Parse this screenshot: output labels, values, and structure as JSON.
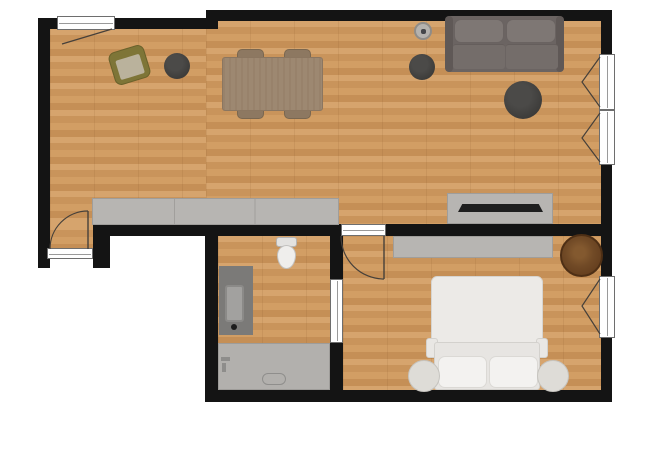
{
  "app": {
    "name": "floor-plan-view",
    "description": "Top-down 2D apartment floor plan with wood flooring, black walls, furnished rooms; no visible text labels"
  },
  "palette": {
    "wall": "#141414",
    "floor_wood_base": "#cf9c64",
    "floor_wood_dark": "#c58f56",
    "furniture_gray": "#b7b5b2",
    "sofa_gray": "#6b6462",
    "pouf_dark": "#3e3d3b",
    "dining_table_wood": "#9d8871",
    "round_table_wood": "#6b4523",
    "armchair_olive": "#7e7537",
    "bed_white": "#eceae7",
    "bathtub_gray": "#b2b0ad",
    "vanity_gray": "#7b7a78",
    "window_frame": "#ffffff",
    "background": "#ffffff"
  },
  "rooms": [
    {
      "name": "living-dining-room",
      "items": [
        "casement window (top wall)",
        "olive armchair",
        "round floor cushion x2",
        "large round floor cushion",
        "round planter",
        "dining table with 4 chairs",
        "two-seat sofa",
        "long sideboard counter",
        "TV sideboard with flat TV",
        "two casement windows (right wall)"
      ]
    },
    {
      "name": "entrance-nook",
      "items": [
        "entrance door with swing arc"
      ]
    },
    {
      "name": "bathroom",
      "items": [
        "toilet",
        "vanity with sink",
        "bathtub with headrest",
        "sliding door to bedroom"
      ]
    },
    {
      "name": "bedroom",
      "items": [
        "hinged door with swing arc",
        "wardrobe",
        "round wooden side table",
        "double bed with two pillows",
        "two round bedside stools",
        "casement window (right wall)"
      ]
    }
  ],
  "furniture": {
    "sofa": {
      "label": "Two-seat sofa"
    },
    "armchair": {
      "label": "Olive armchair"
    },
    "dining_table": {
      "label": "Dining table"
    },
    "dining_chair": {
      "label": "Dining chair"
    },
    "floor_cushion_small_1": {
      "label": "Round floor cushion"
    },
    "floor_cushion_small_2": {
      "label": "Round floor cushion"
    },
    "floor_cushion_large": {
      "label": "Large round floor cushion"
    },
    "planter": {
      "label": "Round planter"
    },
    "kitchen_sideboard": {
      "label": "Long sideboard counter"
    },
    "tv_sideboard": {
      "label": "TV sideboard"
    },
    "tv": {
      "label": "Flat-screen TV"
    },
    "wardrobe": {
      "label": "Wardrobe"
    },
    "round_side_table": {
      "label": "Round wooden side table"
    },
    "bed": {
      "label": "Double bed"
    },
    "pillow": {
      "label": "Pillow"
    },
    "bedside_stool": {
      "label": "Round bedside stool"
    },
    "toilet": {
      "label": "Toilet"
    },
    "vanity": {
      "label": "Vanity with sink"
    },
    "bathtub": {
      "label": "Bathtub"
    }
  },
  "openings": {
    "top_window": {
      "label": "Casement window"
    },
    "right_window_upper": {
      "label": "Casement window"
    },
    "right_window_lower": {
      "label": "Casement window"
    },
    "bedroom_window": {
      "label": "Casement window"
    },
    "entrance_door": {
      "label": "Entrance door"
    },
    "bedroom_door": {
      "label": "Bedroom door"
    },
    "bathroom_door": {
      "label": "Bathroom sliding door"
    }
  }
}
